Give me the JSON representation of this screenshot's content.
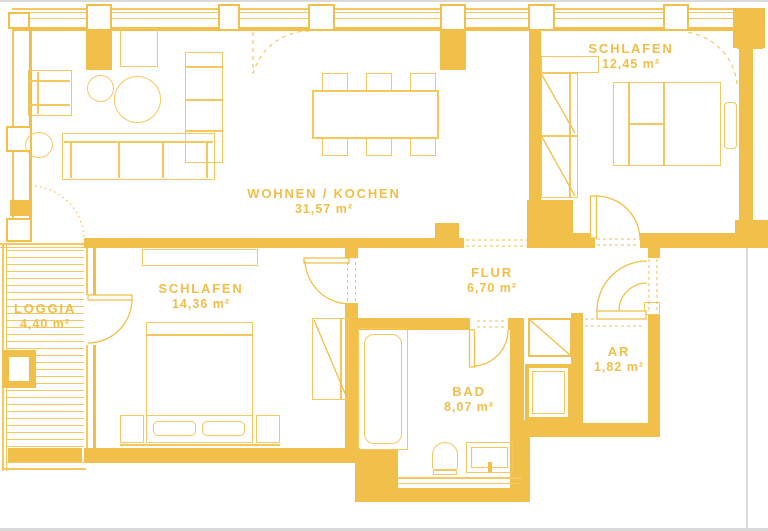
{
  "plan_title": "Apartment floor plan",
  "colors": {
    "wall": "#F1C04A",
    "line": "#F4C75F",
    "text": "#F0BE49",
    "page_edge": "#DADADA"
  },
  "rooms": {
    "wohnen_kochen": {
      "label": "WOHNEN / KOCHEN",
      "area": "31,57 m²"
    },
    "schlafen_right": {
      "label": "SCHLAFEN",
      "area": "12,45 m²"
    },
    "schlafen_left": {
      "label": "SCHLAFEN",
      "area": "14,36 m²"
    },
    "flur": {
      "label": "FLUR",
      "area": "6,70 m²"
    },
    "bad": {
      "label": "BAD",
      "area": "8,07 m²"
    },
    "ar": {
      "label": "AR",
      "area": "1,82 m²"
    },
    "loggia": {
      "label": "LOGGIA",
      "area": "4,40 m²"
    }
  }
}
